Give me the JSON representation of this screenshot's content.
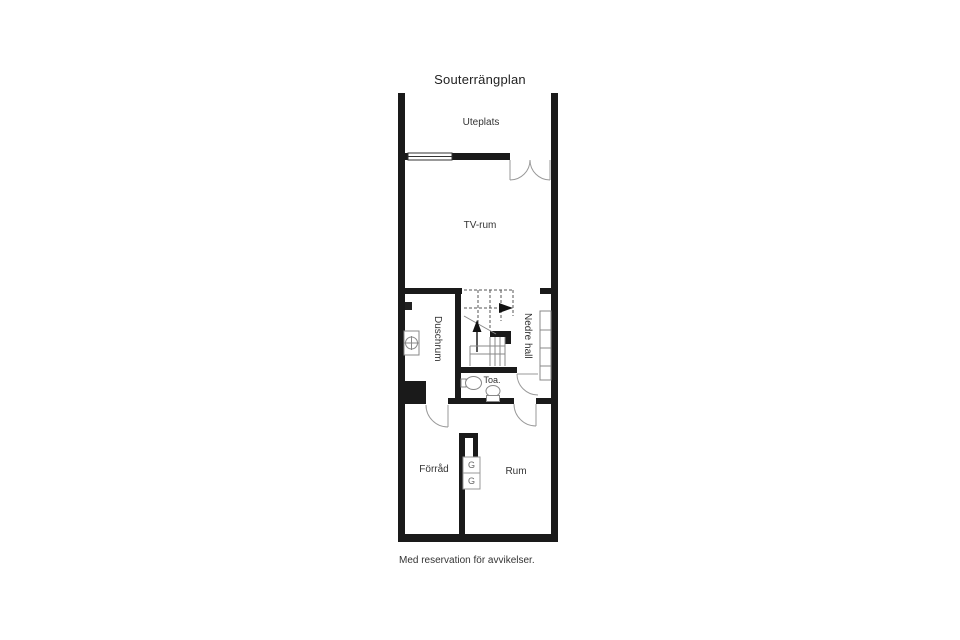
{
  "title": "Souterrängplan",
  "footer": "Med reservation för avvikelser.",
  "rooms": {
    "uteplats": "Uteplats",
    "tv_rum": "TV-rum",
    "duschrum": "Duschrum",
    "nedre_hall": "Nedre hall",
    "toa": "Toa.",
    "forrad": "Förråd",
    "rum": "Rum"
  },
  "closets": {
    "g1": "G",
    "g2": "G"
  },
  "colors": {
    "wall": "#1a1a1a",
    "door_line": "#999999",
    "fixture_line": "#888888",
    "dashed_line": "#555555",
    "text": "#333333"
  }
}
